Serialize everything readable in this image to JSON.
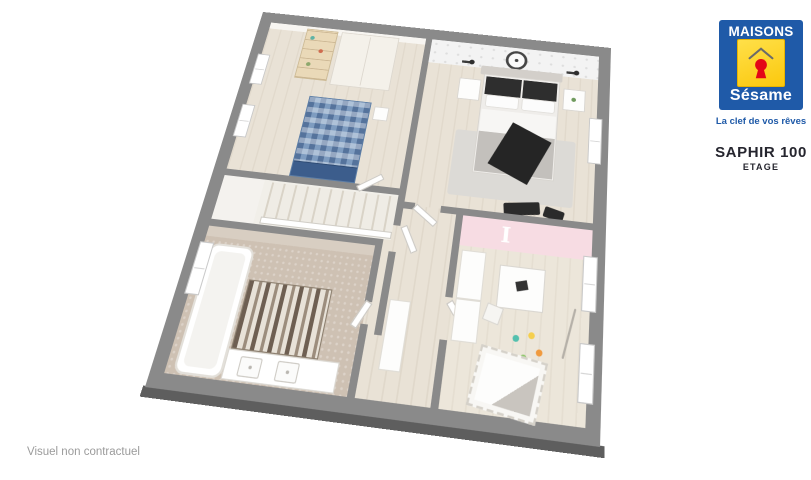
{
  "brand": {
    "name_top": "MAISONS",
    "name_bottom": "Sésame",
    "tagline": "La clef de vos rêves"
  },
  "plan": {
    "title": "SAPHIR 100",
    "subtitle": "ETAGE"
  },
  "rooms": {
    "kids": {
      "wall_letter": "I"
    }
  },
  "footer": {
    "disclaimer": "Visuel non contractuel"
  },
  "colors": {
    "brand_blue": "#1f5aa8",
    "brand_yellow": "#fbc80d",
    "brand_red": "#e30617",
    "slab_gray": "#8a8a8a",
    "slab_edge": "#5e5e5e",
    "wall_gray": "#8a8a8a",
    "wood_floor": "#e9e2d6",
    "pink_wall": "#f7dce3",
    "text_dark": "#25252e",
    "text_muted": "#9b9b9b"
  }
}
